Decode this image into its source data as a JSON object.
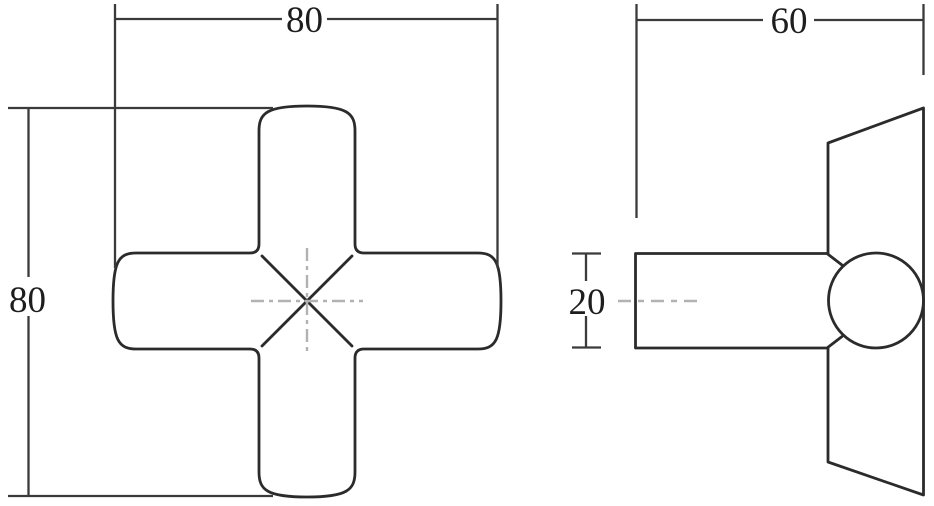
{
  "drawing": {
    "kind": "orthographic technical drawing of a four-lobed cross knob (two views)",
    "front_view": {
      "name": "front view of cross knob",
      "width_dimension": "80",
      "height_dimension": "80"
    },
    "side_view": {
      "name": "side view of cross knob",
      "width_dimension": "60",
      "stem_thickness_dimension": "20"
    },
    "colors": {
      "line": "#2b2b2b",
      "dimension_line": "#3a3a3a",
      "centerline": "#b2b2b2",
      "text": "#1d1d1d",
      "background": "#ffffff"
    }
  }
}
